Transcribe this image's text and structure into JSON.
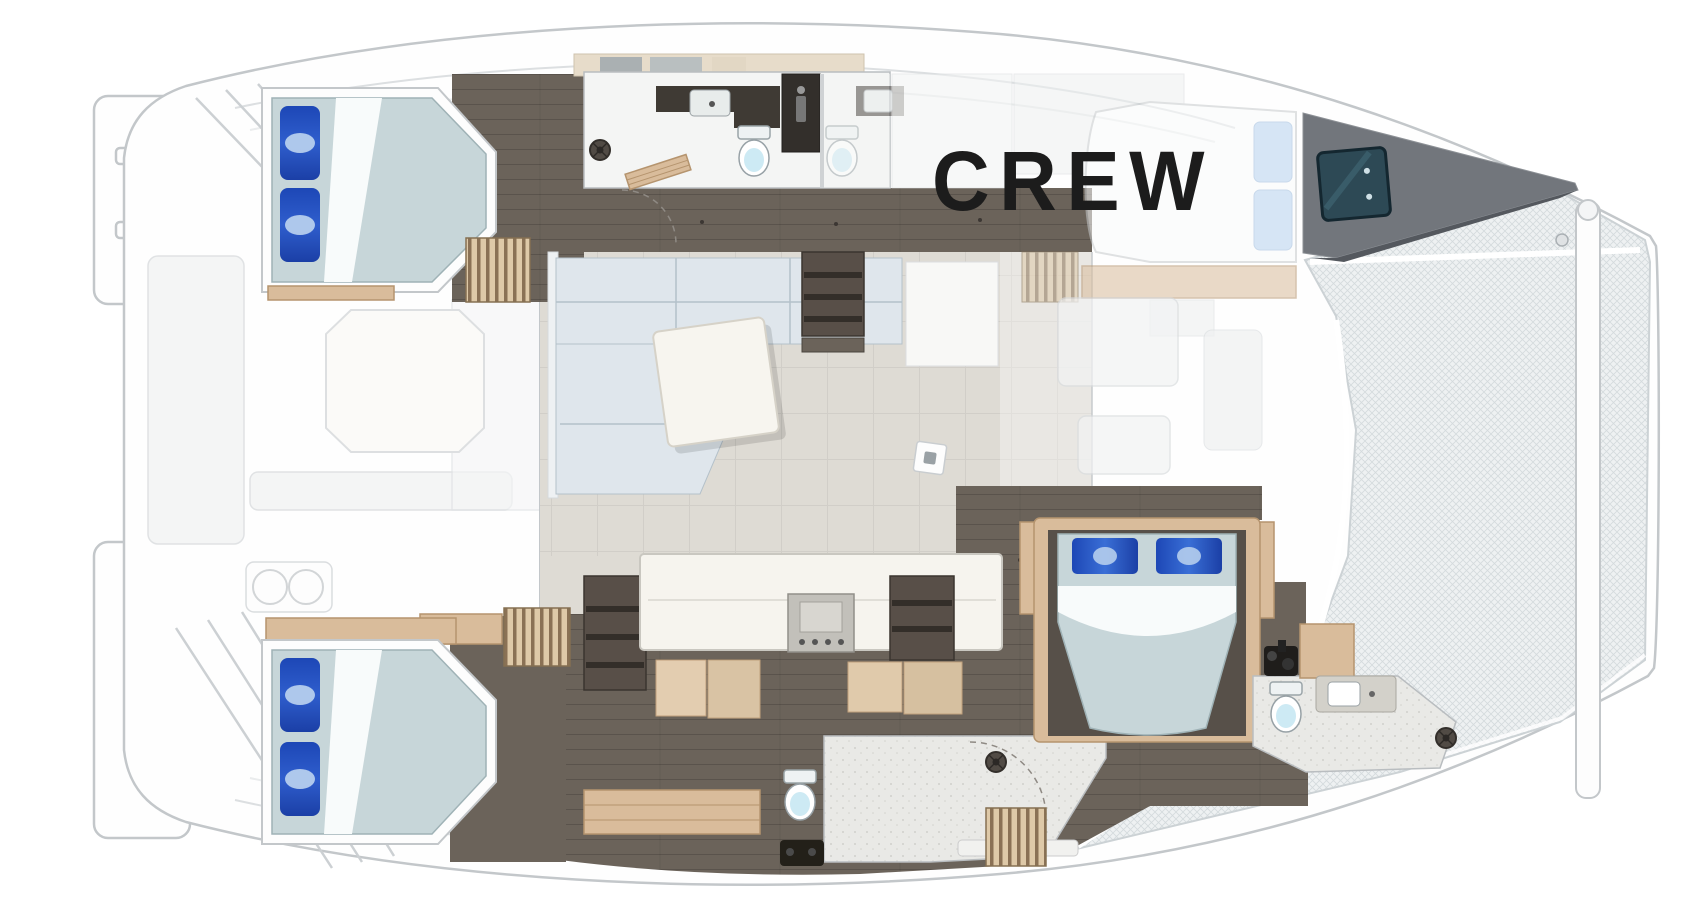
{
  "label": {
    "text": "CREW"
  },
  "colors": {
    "hull_white": "#fefefe",
    "line_gray": "#c3c7ca",
    "floor_dark": "#6b635a",
    "floor_darker": "#57504a",
    "wall_dark": "#3f3a34",
    "wood_tan": "#d9bc9b",
    "stairs_tan": "#dec9a8",
    "stairs_dark": "#8a7155",
    "duvet": "#c7d6d9",
    "pillow_blue": "#2d56c8",
    "pillow_light": "#b7d2ee",
    "sofa_gray": "#dfe6ec",
    "salon_floor": "#dedbd4",
    "counter_white": "#f6f4ee",
    "toilet_lid": "#cdeaf4",
    "hatch_teal": "#2d4955",
    "mesh_bg": "#eef1f2",
    "mesh_line": "#d4dadd",
    "text_black": "#1c1c1c"
  },
  "inventory": {
    "double_beds": 4,
    "toilets": 4,
    "sinks": 3,
    "shower_drains": 3,
    "companionway_stairs": 4,
    "stoves": 1,
    "salon_sofas": 1,
    "salon_tables": 1,
    "cockpit_tables": 1,
    "trampoline_nets": 1,
    "deck_hatches": 1
  }
}
